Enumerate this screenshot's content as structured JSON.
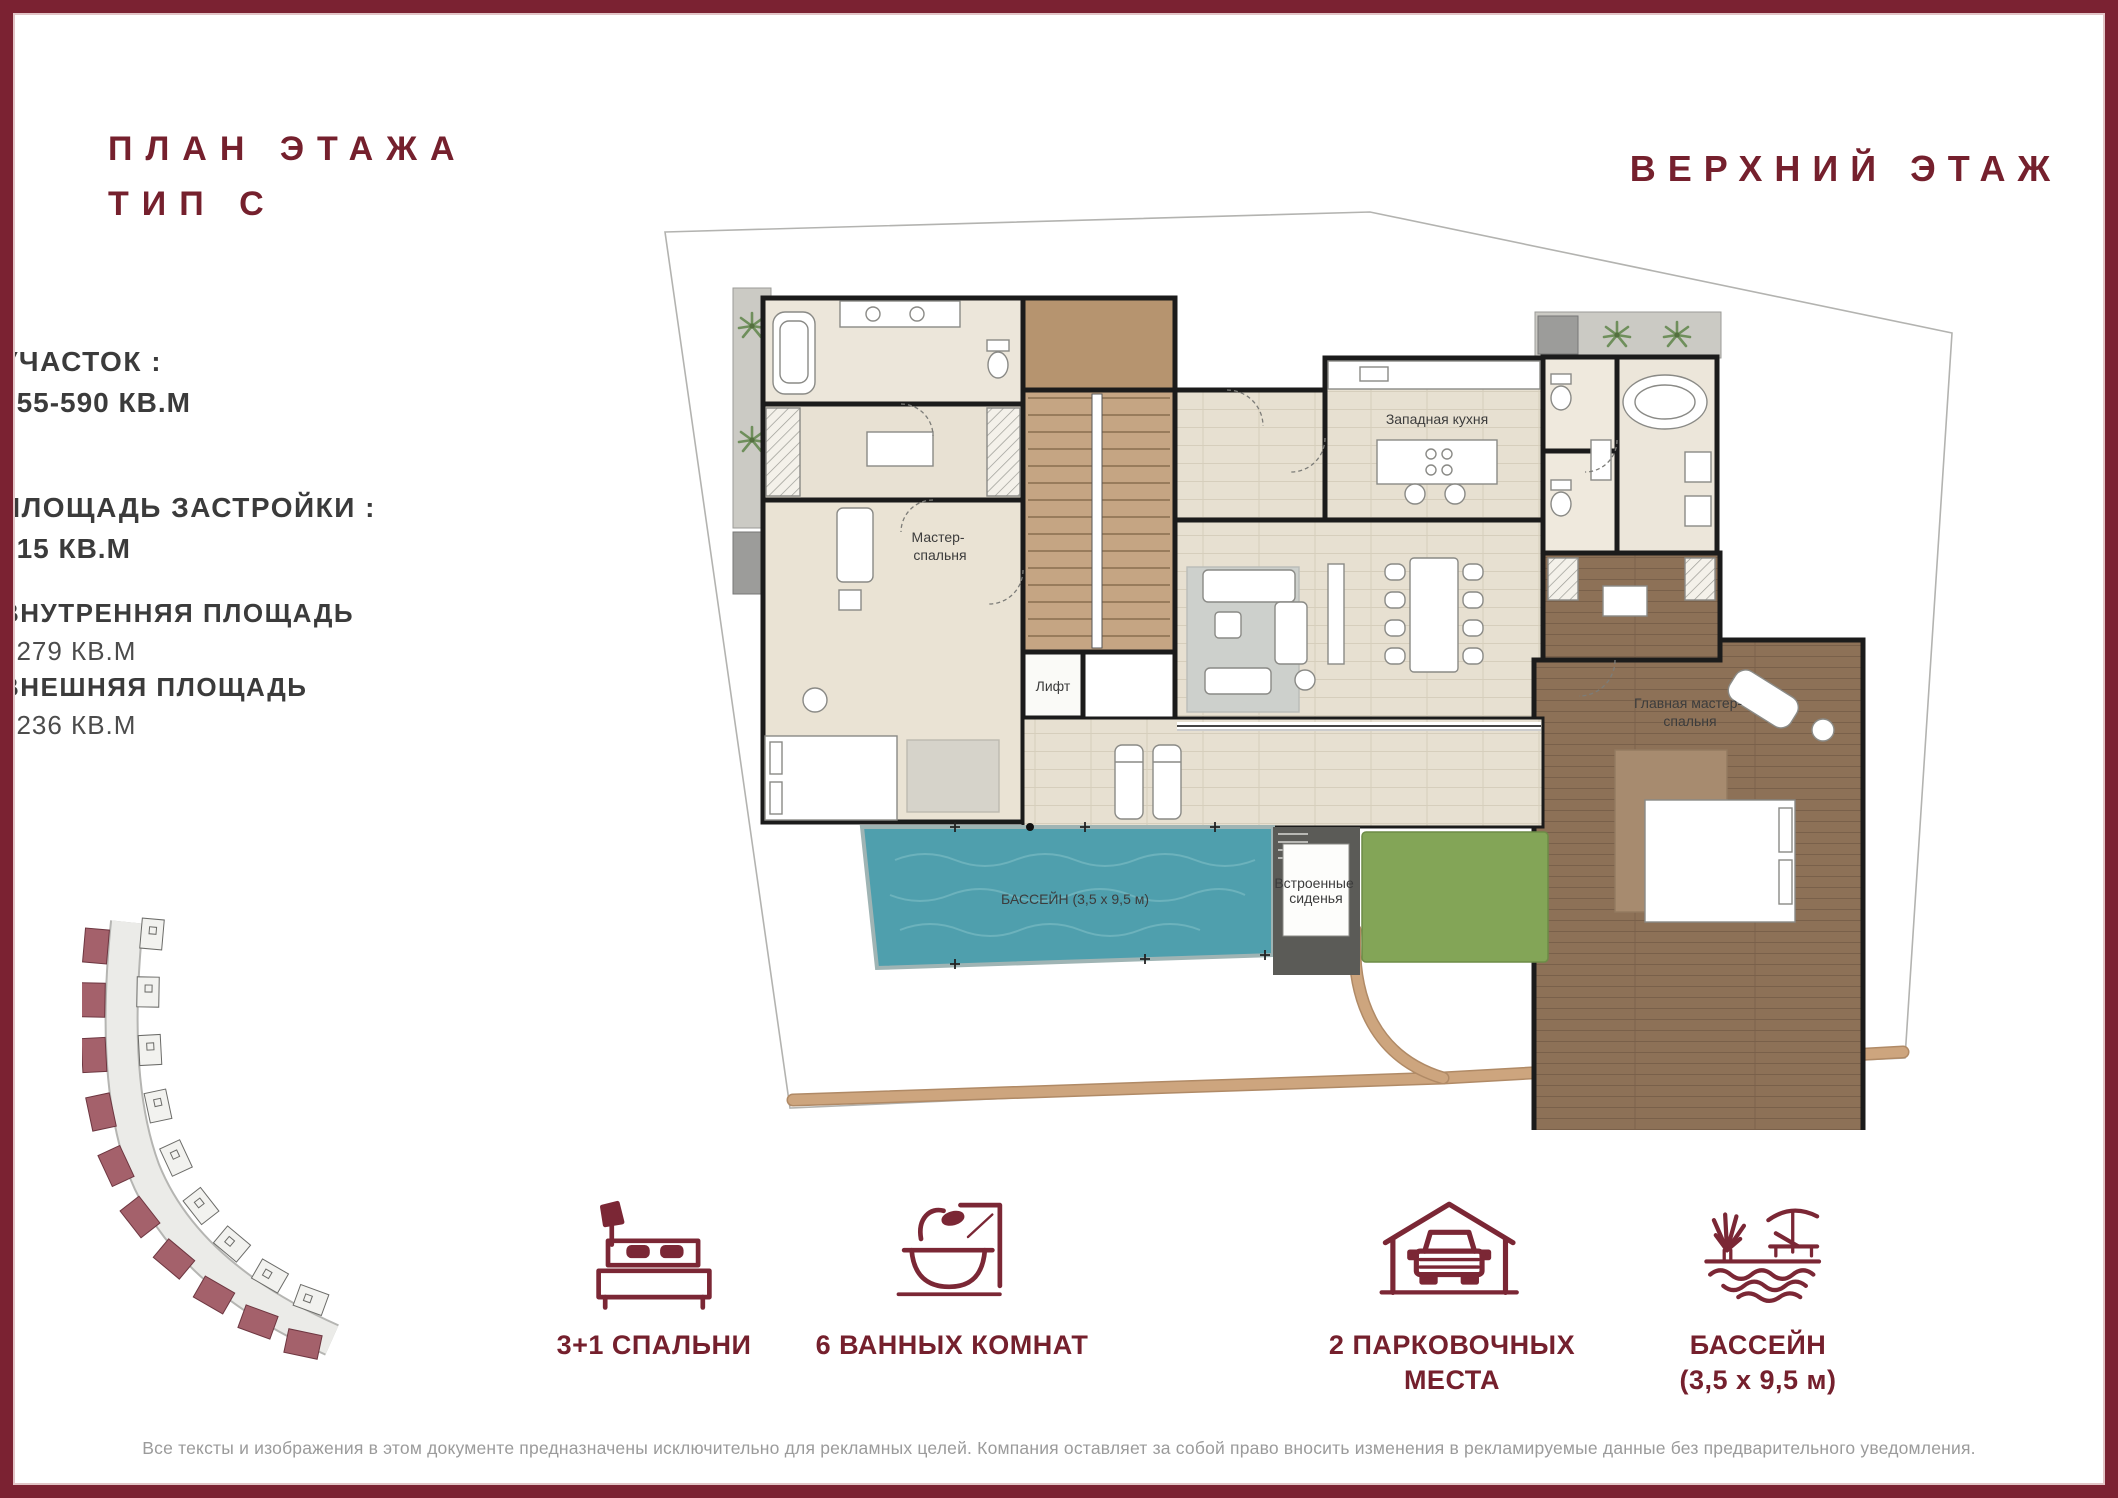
{
  "header": {
    "title_line1": "ПЛАН ЭТАЖА",
    "title_line2": "ТИП C",
    "floor_label": "ВЕРХНИЙ ЭТАЖ"
  },
  "stats": {
    "plot": {
      "label": "УЧАСТОК :",
      "value": "555-590 КВ.М"
    },
    "built": {
      "label": "ПЛОЩАДЬ ЗАСТРОЙКИ :",
      "value": "515 КВ.М"
    },
    "internal": {
      "label": "ВНУТРЕННЯЯ ПЛОЩАДЬ",
      "value": ": 279 КВ.М"
    },
    "external": {
      "label": "ВНЕШНЯЯ ПЛОЩАДЬ",
      "value": ": 236 КВ.М"
    }
  },
  "plan": {
    "labels": {
      "master_bedroom_line1": "Мастер-",
      "master_bedroom_line2": "спальня",
      "kitchen": "Западная кухня",
      "lift": "Лифт",
      "main_master_line1": "Главная мастер-",
      "main_master_line2": "спальня",
      "built_in_seats_line1": "Встроенные",
      "built_in_seats_line2": "сиденья",
      "pool": "БАССЕЙН (3,5 х 9,5 м)"
    }
  },
  "features": {
    "bedrooms": {
      "icon": "bed-icon",
      "label_line1": "3+1 СПАЛЬНИ",
      "label_line2": ""
    },
    "bathrooms": {
      "icon": "bathtub-icon",
      "label_line1": "6 ВАННЫХ КОМНАТ",
      "label_line2": ""
    },
    "parking": {
      "icon": "garage-car-icon",
      "label_line1": "2 ПАРКОВОЧНЫХ",
      "label_line2": "МЕСТА"
    },
    "pool": {
      "icon": "pool-lounger-icon",
      "label_line1": "БАССЕЙН",
      "label_line2": "(3,5 х 9,5 м)"
    }
  },
  "footer": {
    "disclaimer": "Все тексты и изображения в этом документе предназначены исключительно для рекламных целей. Компания оставляет за собой право вносить изменения в рекламируемые данные без предварительного уведомления."
  },
  "colors": {
    "accent_maroon": "#7b2232",
    "pool_water": "#4f9fad",
    "wood_floor": "#8d7157",
    "grass": "#83a557",
    "path_tan": "#c9a27c",
    "wall": "#1b1b1b"
  }
}
